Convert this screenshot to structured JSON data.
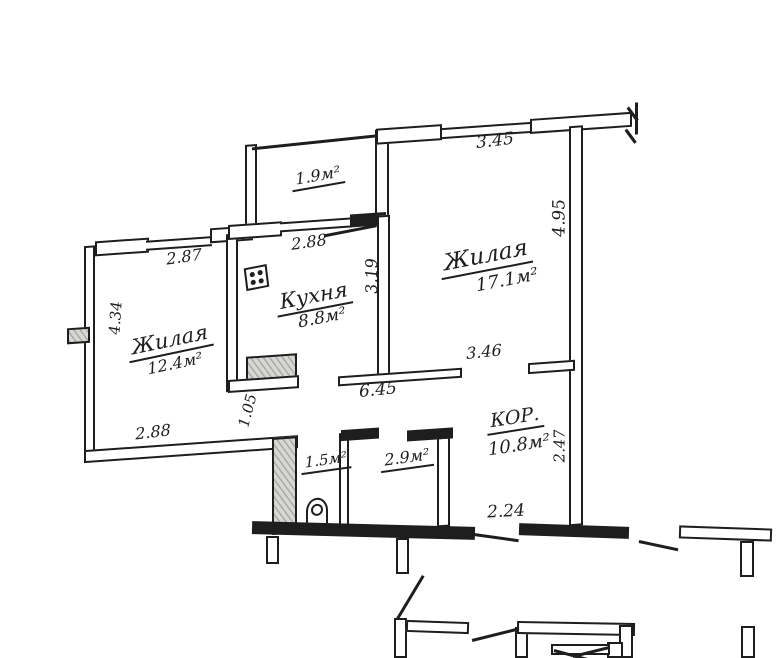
{
  "floorplan": {
    "ink_color": "#1e1e1e",
    "paper_color": "#ffffff",
    "rooms": {
      "living1": {
        "name": "Жилая",
        "area": "12.4м²"
      },
      "living2": {
        "name": "Жилая",
        "area": "17.1м²"
      },
      "kitchen": {
        "name": "Кухня",
        "area": "8.8м²"
      },
      "corridor": {
        "name": "КОР.",
        "area": "10.8м²"
      },
      "balcony": {
        "area": "1.9м²"
      },
      "wc": {
        "area": "1.5м²"
      },
      "bath": {
        "area": "2.9м²"
      }
    },
    "dims": {
      "top_wall": "3.45",
      "living2_right": "4.95",
      "living2_bottom": "3.46",
      "kitchen_window": "2.88",
      "kitchen_right": "3.19",
      "living1_window": "2.87",
      "living1_left": "4.34",
      "living1_bottom": "2.88",
      "living1_door": "1.05",
      "corridor_wall": "6.45",
      "corridor_right": "2.47",
      "entry_wall": "2.24"
    }
  }
}
